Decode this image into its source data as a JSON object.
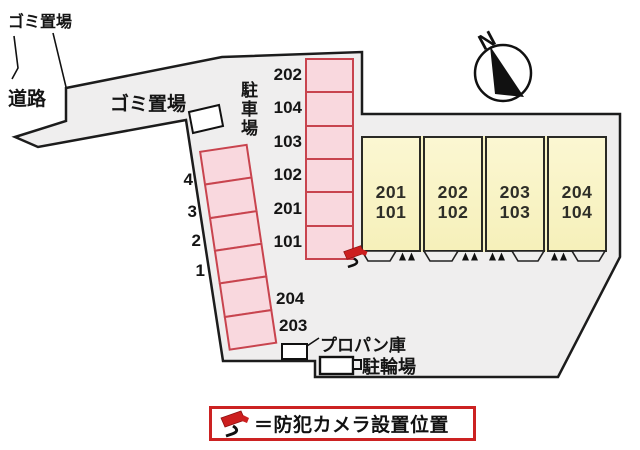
{
  "labels": {
    "garbage_top": "ゴミ置場",
    "road": "道路",
    "garbage_mid": "ゴミ置場",
    "parking_lot": "駐車場",
    "propane": "プロパン庫",
    "bicycle": "駐輪場"
  },
  "compass": {
    "north": "N"
  },
  "parking": {
    "right_column": [
      "202",
      "104",
      "103",
      "102",
      "201",
      "101"
    ],
    "left_column": [
      "4",
      "3",
      "2",
      "1"
    ],
    "bottom": [
      "204",
      "203"
    ]
  },
  "building": {
    "units": [
      {
        "upper": "201",
        "lower": "101"
      },
      {
        "upper": "202",
        "lower": "102"
      },
      {
        "upper": "203",
        "lower": "103"
      },
      {
        "upper": "204",
        "lower": "104"
      }
    ]
  },
  "legend": {
    "text": "＝防犯カメラ設置位置"
  },
  "colors": {
    "site_fill": "#efeeee",
    "outline": "#1c1c1c",
    "parking_fill": "#f9d8de",
    "parking_border": "#c8444e",
    "building_fill": "#f8f3c3",
    "camera_red": "#cc1f1f",
    "legend_border": "#cc2222"
  }
}
